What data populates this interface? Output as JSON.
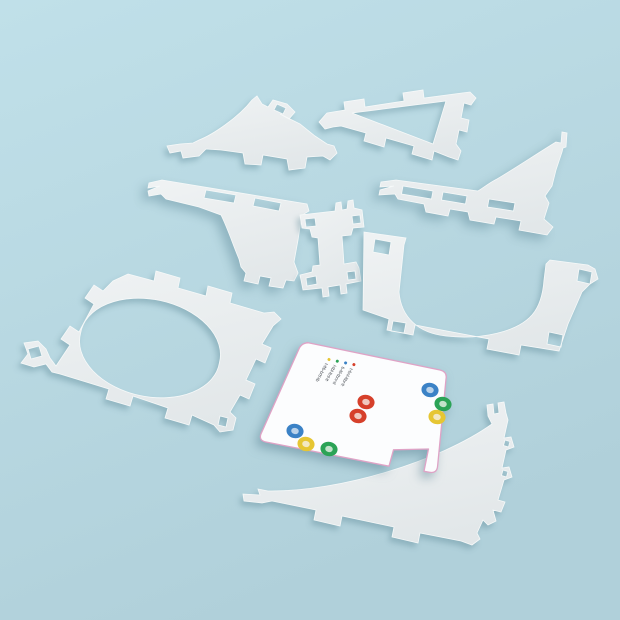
{
  "scene": {
    "kind": "3d-render-product-photo",
    "description": "Nine white die-cut flat snap-together kit pieces arranged diagonally on a light blue surface: two curved gusset sails, a triangle frame, two slotted rails (one with an upswept fin, one with a down leg), a bone-shaped connector, a U-shaped frame, a square ring plate with a large circular hole, and a white controller board with colored grommet rings",
    "colors": {
      "background_top": "#c0e0e9",
      "background_bottom": "#b0d0da",
      "piece_fill_light": "#eff2f3",
      "piece_fill_dark": "#e2e7e9",
      "piece_edge": "#f6f9f9",
      "shadow": "rgba(96,138,152,0.45)"
    }
  },
  "pieces": [
    {
      "id": "sail-gusset-small",
      "label": "small curved gusset plate, top left"
    },
    {
      "id": "triangle-frame",
      "label": "triangular frame with triangular cutout"
    },
    {
      "id": "slotted-rail-fin",
      "label": "slotted rail with upswept fin, right"
    },
    {
      "id": "slotted-rail-leg",
      "label": "slotted rail with curved leg, left"
    },
    {
      "id": "bone-connector",
      "label": "bone shaped connector, center"
    },
    {
      "id": "u-frame",
      "label": "U-shaped frame with tab holes"
    },
    {
      "id": "square-ring-plate",
      "label": "square plate with large circular hole"
    },
    {
      "id": "controller-board",
      "label": "white board with colored grommets and micro legend"
    },
    {
      "id": "sail-gusset-large",
      "label": "large curved gusset plate, bottom right"
    }
  ],
  "board": {
    "fill": "#fcfdfe",
    "edge_color": "#dfa3c6",
    "text_color": "#3c4148",
    "legend_items": [
      {
        "color_name": "yellow",
        "dot": "#e6c633",
        "label": "t-ltb-brtl-tb"
      },
      {
        "color_name": "green",
        "dot": "#2ba356",
        "label": "l-tbl-ltnl-lt"
      },
      {
        "color_name": "blue",
        "dot": "#3b82c6",
        "label": "b-ltl-tbnr-tl"
      },
      {
        "color_name": "red",
        "dot": "#d6402b",
        "label": "t-bnl-ltbr-lt"
      }
    ],
    "legend_anchor": {
      "x": 329,
      "y": 359.5,
      "step_x": 8.3,
      "step_y": 1.7,
      "angle_deg": 119
    },
    "ring_colors": {
      "blue": {
        "ring": "#3b82c6",
        "center": "#b9d2ea"
      },
      "green": {
        "ring": "#2ba356",
        "center": "#c2e2ca"
      },
      "yellow": {
        "ring": "#e6c633",
        "center": "#f3e8c2"
      },
      "red": {
        "ring": "#d6402b",
        "center": "#f0c9bf"
      }
    },
    "rings": [
      {
        "color": "blue",
        "x": 430,
        "y": 390
      },
      {
        "color": "green",
        "x": 443,
        "y": 404
      },
      {
        "color": "yellow",
        "x": 437,
        "y": 417
      },
      {
        "color": "red",
        "x": 366,
        "y": 402
      },
      {
        "color": "red",
        "x": 358,
        "y": 416
      },
      {
        "color": "blue",
        "x": 295,
        "y": 431
      },
      {
        "color": "yellow",
        "x": 306,
        "y": 444
      },
      {
        "color": "green",
        "x": 329,
        "y": 449
      }
    ],
    "ring_size": {
      "rx": 8.6,
      "ry": 7.2,
      "inner_rx": 3.8,
      "inner_ry": 3.1,
      "tilt_deg": 12
    }
  }
}
